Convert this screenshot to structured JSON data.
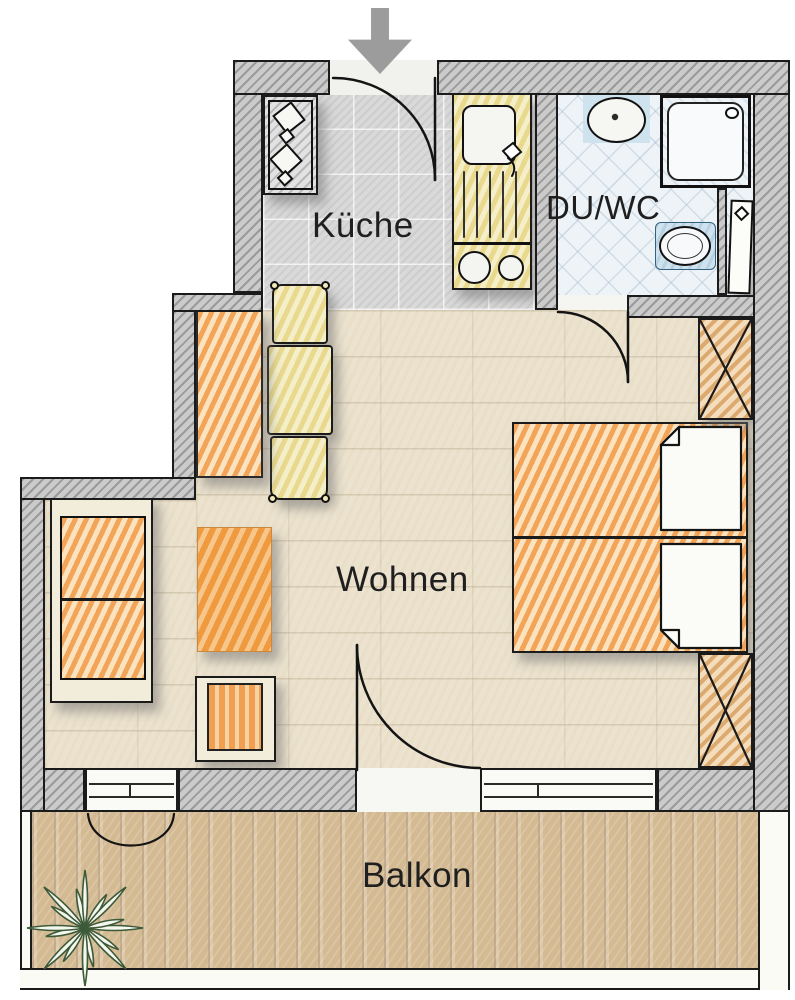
{
  "floorplan": {
    "type": "apartment-floor-plan",
    "rooms": [
      {
        "id": "kueche",
        "label": "Küche"
      },
      {
        "id": "du_wc",
        "label": "DU/WC"
      },
      {
        "id": "wohnen",
        "label": "Wohnen"
      },
      {
        "id": "balkon",
        "label": "Balkon"
      }
    ],
    "entrance": {
      "icon": "entrance-arrow",
      "direction": "down"
    },
    "fixtures": [
      "stove-with-two-burners",
      "kitchen-sink-unit-with-hotplates",
      "washbasin",
      "shower",
      "toilet",
      "radiator"
    ],
    "furniture": [
      "sideboard",
      "dining-table",
      "dining-chair",
      "dining-chair",
      "sofa",
      "coffee-table",
      "armchair",
      "double-bed",
      "pillow",
      "pillow",
      "wardrobe",
      "wardrobe",
      "potted-plant"
    ],
    "colors": {
      "wall_hatch": "#9a9a9a",
      "outline": "#1b1b1b",
      "kitchen_floor": "#d9d9d9",
      "bath_floor": "#eef3f7",
      "bath_accent": "#cfe3ee",
      "living_floor": "#ebe3d0",
      "balcony_floor": "#d4ba92",
      "furniture_orange": "#f2a558",
      "unit_yellow": "#e8d98f",
      "plant_green": "#3c5a38",
      "arrow_gray": "#9c9c9c"
    }
  }
}
